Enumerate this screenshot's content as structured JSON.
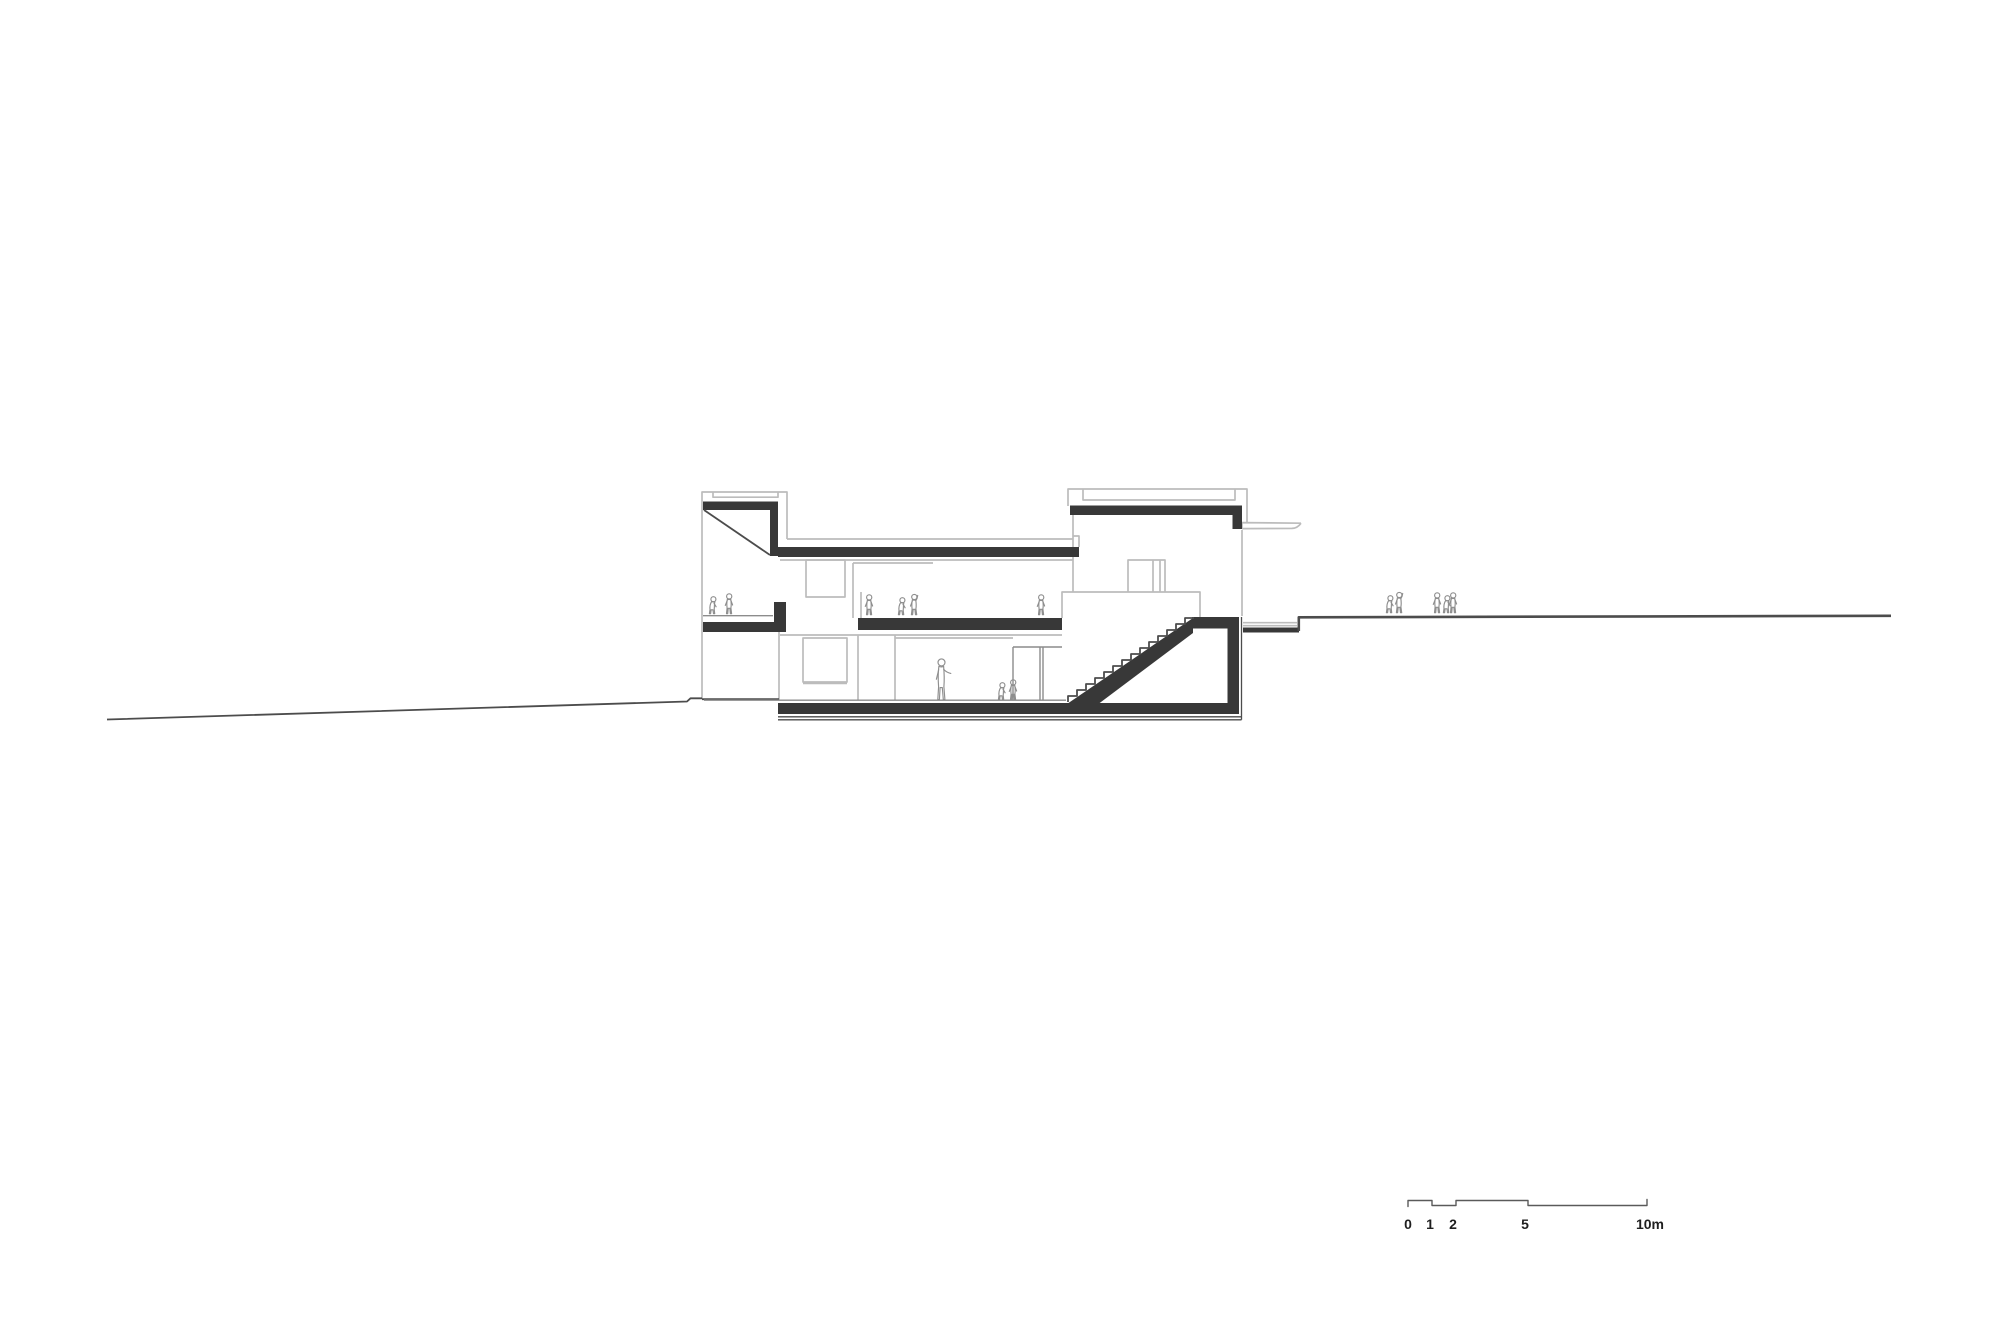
{
  "drawing": {
    "type": "architectural longitudinal section",
    "description": "black and white section through a two-storey building on a sloping site with internal and external stairs, children and adult figures"
  },
  "scalebar": {
    "labels": [
      "0",
      "1",
      "2",
      "5",
      "10m"
    ],
    "unit": "m",
    "max_meters": 10
  },
  "colors": {
    "background": "#ffffff",
    "poche": "#383838",
    "line_dark": "#4c4c4c",
    "line_medium": "#8c8c8c",
    "line_light": "#bcbcbc",
    "figure": "#8e8e8e",
    "scalebar_line": "#5a5a5a",
    "scalebar_text": "#1f1f1f"
  }
}
